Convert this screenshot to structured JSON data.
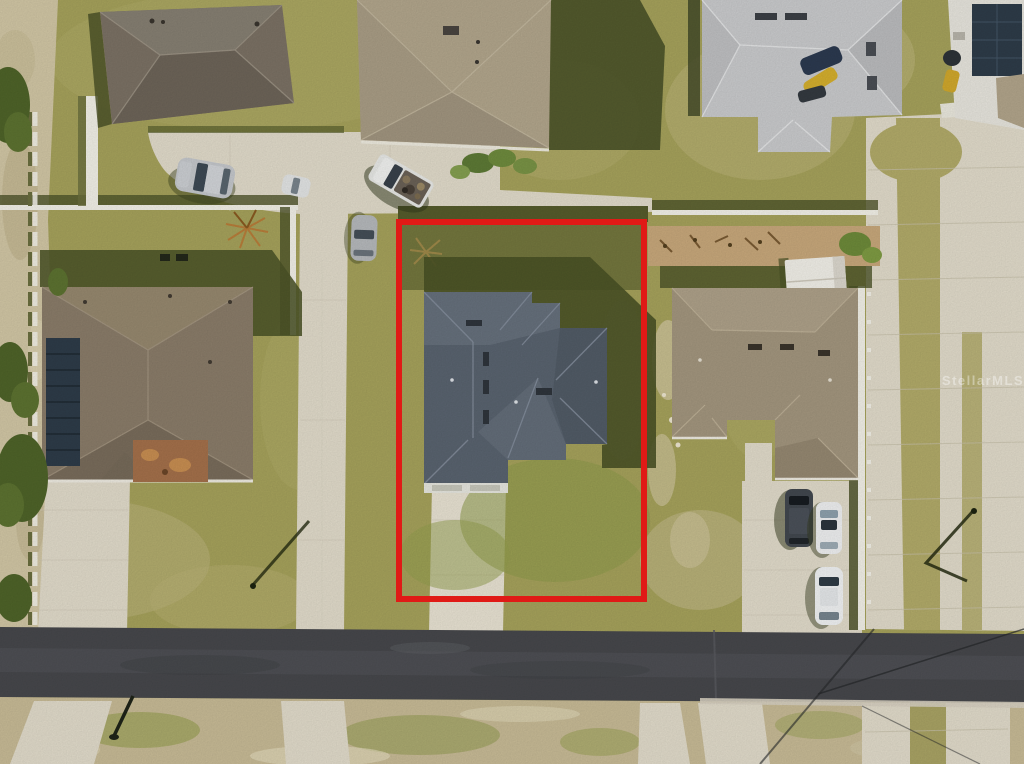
{
  "watermark": {
    "text": "StellarMLS"
  },
  "colors": {
    "grass_base": "#a7a35c",
    "grass_shadow": "#4c5428",
    "sand": "#d3c8a6",
    "sand_bottom": "#c9bc97",
    "concrete": "#e3ddcc",
    "asphalt": "#47484c",
    "boundary_red": "#e01a16",
    "roof_subject": "#5a6470",
    "roof_left_house": "#8b7d6a",
    "roof_top_left": "#7c7265",
    "roof_top_center": "#b3a78d",
    "roof_top_right": "#cbccce",
    "roof_right_house": "#a4977f",
    "solar_panel": "#2e3c49",
    "fence_white": "#f4f2e9",
    "mulch": "#c9a97c",
    "shed_white": "#f3f1ea",
    "car_silver": "#c6c9cd",
    "car_white": "#f0f1f2",
    "car_dark": "#42484f",
    "tree_green": "#4f6429"
  }
}
